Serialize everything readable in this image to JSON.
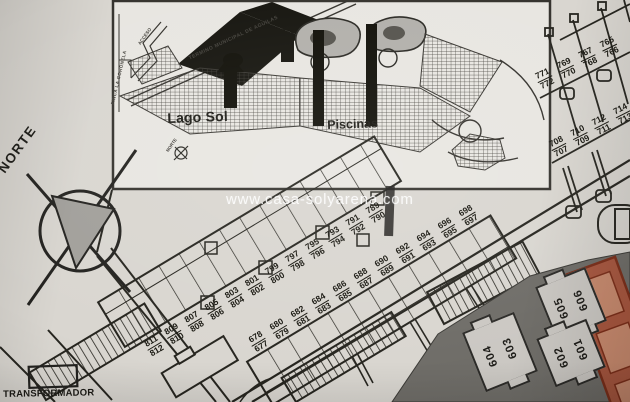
{
  "watermark": "www.casa-solyarena.com",
  "labels": {
    "norte": "NORTE",
    "transformador": "TRANSFORMADOR"
  },
  "inset": {
    "lago_sol": "Lago Sol",
    "piscinas": "Piscinas",
    "termino_municipal": "TERMINO MUNICIPAL DE AGUILAS",
    "finca": "FINCA LA CORONELA",
    "acceso": "ACCESO",
    "norte": "NORTE"
  },
  "lot_rows": [
    {
      "name": "row-800s",
      "x": 144,
      "y": 352,
      "angle": -31,
      "spacing": 23.5,
      "pairs": [
        "811/812",
        "809/810",
        "807/808",
        "805/806",
        "803/804",
        "801/802",
        "799/800",
        "797/798",
        "795/796",
        "793/794",
        "791/792",
        "789/790"
      ]
    },
    {
      "name": "row-600s",
      "x": 248,
      "y": 348,
      "angle": -31,
      "spacing": 24.5,
      "pairs": [
        "678/677",
        "680/679",
        "682/681",
        "684/683",
        "686/685",
        "688/687",
        "690/689",
        "692/691",
        "694/693",
        "696/695",
        "698/697"
      ]
    },
    {
      "name": "row-760s",
      "x": 534,
      "y": 84,
      "angle": -26,
      "spacing": 24,
      "pairs": [
        "771/772",
        "769/770",
        "767/768",
        "765/766"
      ]
    },
    {
      "name": "row-710s",
      "x": 548,
      "y": 152,
      "angle": -27,
      "spacing": 24,
      "pairs": [
        "708/707",
        "710/709",
        "712/711",
        "714/713"
      ]
    }
  ],
  "buildings": [
    {
      "labels": [
        "604",
        "603"
      ],
      "x": 500,
      "y": 352,
      "w": 56,
      "h": 64,
      "angle": -22
    },
    {
      "labels": [
        "605",
        "606"
      ],
      "x": 571,
      "y": 304,
      "w": 54,
      "h": 58,
      "angle": -22
    },
    {
      "labels": [
        "602",
        "601"
      ],
      "x": 571,
      "y": 353,
      "w": 54,
      "h": 52,
      "angle": -22
    }
  ],
  "colors": {
    "paper": "#d9d6d0",
    "ink": "#26251f",
    "dark_zone": "#6f6d68",
    "gray_building": "#cbc8c3",
    "red_building_fill": "#a8573f",
    "red_building_outline": "#7c2f1a",
    "black_fill": "#16150f",
    "watermark_text": "rgba(255,255,255,0.85)"
  }
}
